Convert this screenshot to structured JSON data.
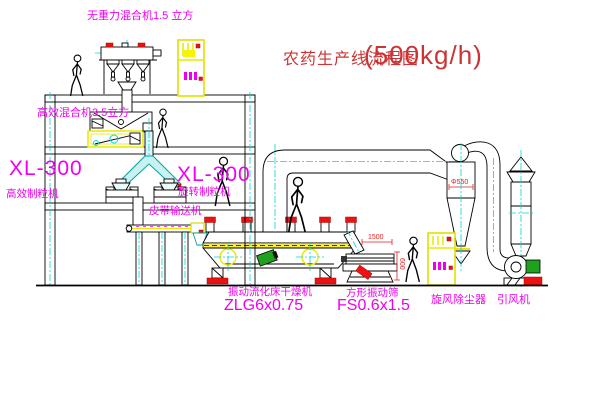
{
  "page": {
    "background": "#ffffff"
  },
  "title": {
    "main": "农药生产线流程图",
    "capacity": "(500kg/h)"
  },
  "labels": {
    "gravity_mixer": "无重力混合机1.5 立方",
    "high_efficiency_mixer": "高效混合机3.5立方",
    "granulator_left_model": "XL-300",
    "granulator_left_name": "高效制粒机",
    "granulator_right_model": "XL-300",
    "granulator_right_name": "旋转制粒机",
    "belt_conveyor": "皮带输送机",
    "dryer_name": "振动流化床干燥机",
    "dryer_model": "ZLG6x0.75",
    "sieve_name": "方形振动筛",
    "sieve_model": "FS0.6x1.5",
    "cyclone": "旋风除尘器",
    "induced_draft_fan": "引风机"
  },
  "dimensions": {
    "sieve_length": "1500",
    "sieve_height": "600",
    "cyclone_note": "Φ550"
  },
  "colors": {
    "line": "#000000",
    "centerline": "#00d8d8",
    "label_magenta": "#ee00ee",
    "title_red": "#cd3333",
    "dimension_red": "#dd2222",
    "cabinet_yellow": "#e8e800",
    "motor_green": "#1fa01f",
    "accent_red": "#ee1111"
  }
}
